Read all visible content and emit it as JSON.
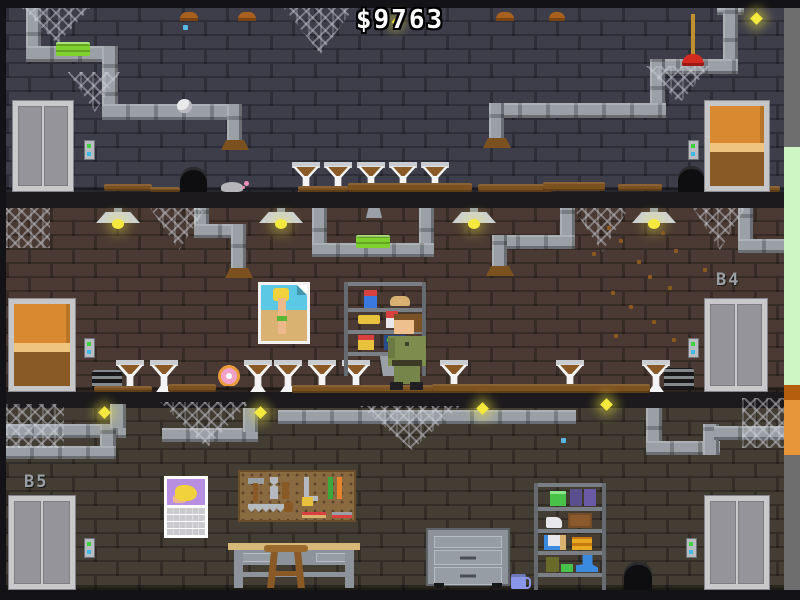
{
  "hud": {
    "money": "$9763"
  },
  "floor_labels": {
    "b4": "B4",
    "b5": "B5"
  },
  "palette": {
    "wall_top": "#3e3e4b",
    "wall_mid": "#4a3a33",
    "wall_bottom": "#433d33",
    "pipe": "#9aa0a5",
    "accent_green": "#7ed12e",
    "firefly": "#f5e93e",
    "door_wood": "#d98a30",
    "dirt": "#7c5120",
    "label_text": "#9aa0a5",
    "outside_green": "#cdf6c4",
    "outside_orange": "#e8963a"
  },
  "objects": {
    "floor_top": [
      "elevator",
      "pipes",
      "green-sponge",
      "cobwebs",
      "dirty-urinals",
      "mouse",
      "mouse-holes",
      "wooden-door",
      "plunger",
      "fireflies"
    ],
    "floor_b4": [
      "wooden-door",
      "hanging-lamps",
      "pipes",
      "green-sponge",
      "pinup-poster",
      "supply-shelf",
      "janitor",
      "dirty-urinals",
      "donut",
      "flies",
      "elevator"
    ],
    "floor_b5": [
      "elevator",
      "pipes",
      "fireflies",
      "cobwebs",
      "pinup-calendar",
      "pegboard-tools",
      "workbench",
      "stool",
      "rolling-cabinet",
      "mug",
      "storage-shelf",
      "mouse-hole",
      "elevator-right"
    ]
  },
  "sprites": [
    {
      "t": "pv",
      "x": 26,
      "y": 8,
      "w": 15,
      "h": 52,
      "n": "pipe-segment"
    },
    {
      "t": "ph",
      "x": 26,
      "y": 46,
      "w": 92,
      "h": 16,
      "n": "pipe-segment"
    },
    {
      "t": "pv",
      "x": 102,
      "y": 46,
      "w": 16,
      "h": 74,
      "n": "pipe-segment"
    },
    {
      "t": "ph",
      "x": 102,
      "y": 104,
      "w": 140,
      "h": 16,
      "n": "pipe-segment"
    },
    {
      "t": "pv",
      "x": 227,
      "y": 104,
      "w": 15,
      "h": 40,
      "n": "pipe-segment"
    },
    {
      "t": "rust",
      "x": 221,
      "y": 140,
      "w": 28,
      "h": 10,
      "n": "rust-stain"
    },
    {
      "t": "ph",
      "x": 717,
      "y": 8,
      "w": 27,
      "h": 7,
      "n": "pipe-flange"
    },
    {
      "t": "pv",
      "x": 723,
      "y": 8,
      "w": 15,
      "h": 58,
      "n": "pipe-segment"
    },
    {
      "t": "ph",
      "x": 652,
      "y": 59,
      "w": 86,
      "h": 15,
      "n": "pipe-segment"
    },
    {
      "t": "pv",
      "x": 650,
      "y": 59,
      "w": 15,
      "h": 55,
      "n": "pipe-segment"
    },
    {
      "t": "ph",
      "x": 494,
      "y": 103,
      "w": 172,
      "h": 15,
      "n": "pipe-segment"
    },
    {
      "t": "pv",
      "x": 489,
      "y": 103,
      "w": 15,
      "h": 39,
      "n": "pipe-segment"
    },
    {
      "t": "rust",
      "x": 483,
      "y": 138,
      "w": 28,
      "h": 10,
      "n": "rust-stain"
    },
    {
      "t": "sponge",
      "x": 56,
      "y": 42,
      "w": 34,
      "h": 14,
      "n": "green-sponge",
      "i": 1
    },
    {
      "t": "cap",
      "x": 180,
      "y": 12,
      "w": 18,
      "h": 9,
      "n": "ceiling-cap"
    },
    {
      "t": "cap",
      "x": 238,
      "y": 12,
      "w": 18,
      "h": 9,
      "n": "ceiling-cap"
    },
    {
      "t": "cap",
      "x": 496,
      "y": 12,
      "w": 18,
      "h": 9,
      "n": "ceiling-cap"
    },
    {
      "t": "cap",
      "x": 549,
      "y": 12,
      "w": 16,
      "h": 9,
      "n": "ceiling-cap"
    },
    {
      "t": "webt",
      "x": 22,
      "y": 8,
      "w": 68,
      "h": 36,
      "n": "cobweb",
      "i": 1
    },
    {
      "t": "webt",
      "x": 68,
      "y": 72,
      "w": 52,
      "h": 40,
      "n": "cobweb",
      "i": 1
    },
    {
      "t": "webt",
      "x": 284,
      "y": 8,
      "w": 70,
      "h": 46,
      "n": "cobweb",
      "i": 1
    },
    {
      "t": "webt",
      "x": 646,
      "y": 66,
      "w": 64,
      "h": 38,
      "n": "cobweb",
      "i": 1
    },
    {
      "t": "fly-y",
      "x": 752,
      "y": 14,
      "w": 9,
      "h": 9,
      "n": "firefly"
    },
    {
      "t": "fly-y",
      "x": 393,
      "y": 19,
      "w": 6,
      "h": 6,
      "n": "firefly"
    },
    {
      "t": "fly-b",
      "x": 183,
      "y": 25,
      "w": 5,
      "h": 5,
      "n": "blue-speck"
    },
    {
      "t": "paper",
      "x": 177,
      "y": 99,
      "w": 15,
      "h": 14,
      "n": "paper-ball",
      "i": 1
    },
    {
      "t": "plunger",
      "x": 682,
      "y": 14,
      "w": 22,
      "h": 52,
      "n": "plunger",
      "i": 1
    },
    {
      "t": "hole",
      "x": 180,
      "y": 167,
      "w": 27,
      "h": 25,
      "n": "mouse-hole"
    },
    {
      "t": "hole",
      "x": 678,
      "y": 166,
      "w": 27,
      "h": 26,
      "n": "mouse-hole"
    },
    {
      "t": "mouse",
      "x": 221,
      "y": 177,
      "w": 30,
      "h": 15,
      "n": "mouse",
      "i": 1
    },
    {
      "t": "callbtn",
      "x": 84,
      "y": 140,
      "n": "elevator-call-button",
      "i": 1
    },
    {
      "t": "callbtn",
      "x": 688,
      "y": 140,
      "n": "elevator-call-button",
      "i": 1
    },
    {
      "t": "funnel",
      "x": 292,
      "y": 162,
      "w": 28,
      "h": 30,
      "n": "dirty-urinal",
      "i": 1
    },
    {
      "t": "funnel",
      "x": 324,
      "y": 162,
      "w": 28,
      "h": 30,
      "n": "dirty-urinal",
      "i": 1
    },
    {
      "t": "funnel",
      "x": 357,
      "y": 162,
      "w": 28,
      "h": 30,
      "n": "dirty-urinal",
      "i": 1
    },
    {
      "t": "funnel",
      "x": 389,
      "y": 162,
      "w": 28,
      "h": 30,
      "n": "dirty-urinal",
      "i": 1
    },
    {
      "t": "funnel",
      "x": 421,
      "y": 162,
      "w": 28,
      "h": 30,
      "n": "dirty-urinal",
      "i": 1
    },
    {
      "t": "dirt",
      "x": 104,
      "y": 184,
      "w": 48,
      "h": 7,
      "n": "dirt-patch",
      "i": 1
    },
    {
      "t": "dirt",
      "x": 150,
      "y": 187,
      "w": 30,
      "h": 5,
      "n": "dirt-patch",
      "i": 1
    },
    {
      "t": "dirt",
      "x": 298,
      "y": 186,
      "w": 50,
      "h": 6,
      "n": "dirt-patch",
      "i": 1
    },
    {
      "t": "dirt",
      "x": 348,
      "y": 183,
      "w": 124,
      "h": 9,
      "n": "dirt-patch",
      "i": 1
    },
    {
      "t": "dirt",
      "x": 478,
      "y": 184,
      "w": 74,
      "h": 8,
      "n": "dirt-patch",
      "i": 1
    },
    {
      "t": "dirt",
      "x": 543,
      "y": 182,
      "w": 62,
      "h": 9,
      "n": "dirt-patch",
      "i": 1
    },
    {
      "t": "dirt",
      "x": 618,
      "y": 184,
      "w": 44,
      "h": 7,
      "n": "dirt-patch",
      "i": 1
    },
    {
      "t": "dirt",
      "x": 752,
      "y": 186,
      "w": 28,
      "h": 6,
      "n": "dirt-patch",
      "i": 1
    },
    {
      "t": "pv",
      "x": 194,
      "y": 208,
      "w": 15,
      "h": 30,
      "n": "pipe-segment"
    },
    {
      "t": "ph",
      "x": 194,
      "y": 224,
      "w": 52,
      "h": 14,
      "n": "pipe-segment"
    },
    {
      "t": "pv",
      "x": 231,
      "y": 224,
      "w": 15,
      "h": 48,
      "n": "pipe-segment"
    },
    {
      "t": "rust",
      "x": 225,
      "y": 268,
      "w": 28,
      "h": 10,
      "n": "rust-stain"
    },
    {
      "t": "pv",
      "x": 312,
      "y": 208,
      "w": 15,
      "h": 48,
      "n": "pipe-segment"
    },
    {
      "t": "pv",
      "x": 419,
      "y": 208,
      "w": 15,
      "h": 48,
      "n": "pipe-segment"
    },
    {
      "t": "ph",
      "x": 312,
      "y": 243,
      "w": 122,
      "h": 14,
      "n": "pipe-segment"
    },
    {
      "t": "sponge",
      "x": 356,
      "y": 235,
      "w": 34,
      "h": 13,
      "n": "green-sponge",
      "i": 1
    },
    {
      "t": "pv",
      "x": 560,
      "y": 208,
      "w": 15,
      "h": 30,
      "n": "pipe-segment"
    },
    {
      "t": "ph",
      "x": 492,
      "y": 235,
      "w": 83,
      "h": 14,
      "n": "pipe-segment"
    },
    {
      "t": "pv",
      "x": 492,
      "y": 235,
      "w": 15,
      "h": 34,
      "n": "pipe-segment"
    },
    {
      "t": "rust",
      "x": 486,
      "y": 266,
      "w": 28,
      "h": 10,
      "n": "rust-stain"
    },
    {
      "t": "pv",
      "x": 738,
      "y": 208,
      "w": 15,
      "h": 34,
      "n": "pipe-segment"
    },
    {
      "t": "ph",
      "x": 738,
      "y": 239,
      "w": 46,
      "h": 14,
      "n": "pipe-segment"
    },
    {
      "t": "graycap",
      "x": 366,
      "y": 208,
      "w": 16,
      "h": 10,
      "n": "ceiling-mount"
    },
    {
      "t": "lamp",
      "x": 96,
      "y": 208,
      "w": 44,
      "h": 22,
      "n": "hanging-lamp"
    },
    {
      "t": "lamp",
      "x": 259,
      "y": 208,
      "w": 44,
      "h": 22,
      "n": "hanging-lamp"
    },
    {
      "t": "lamp",
      "x": 452,
      "y": 208,
      "w": 44,
      "h": 22,
      "n": "hanging-lamp"
    },
    {
      "t": "lamp",
      "x": 632,
      "y": 208,
      "w": 44,
      "h": 22,
      "n": "hanging-lamp"
    },
    {
      "t": "web",
      "x": 6,
      "y": 208,
      "w": 44,
      "h": 40,
      "n": "cobweb",
      "i": 1
    },
    {
      "t": "webt",
      "x": 150,
      "y": 208,
      "w": 56,
      "h": 42,
      "n": "cobweb",
      "i": 1
    },
    {
      "t": "webt",
      "x": 573,
      "y": 208,
      "w": 56,
      "h": 44,
      "n": "cobweb",
      "i": 1
    },
    {
      "t": "webt",
      "x": 693,
      "y": 208,
      "w": 52,
      "h": 42,
      "n": "cobweb",
      "i": 1
    },
    {
      "t": "speck",
      "x": 607,
      "y": 226,
      "n": "fly"
    },
    {
      "t": "speck",
      "x": 619,
      "y": 239,
      "n": "fly"
    },
    {
      "t": "speck",
      "x": 661,
      "y": 231,
      "n": "fly"
    },
    {
      "t": "speck",
      "x": 674,
      "y": 249,
      "n": "fly"
    },
    {
      "t": "speck",
      "x": 637,
      "y": 260,
      "n": "fly"
    },
    {
      "t": "speck",
      "x": 648,
      "y": 275,
      "n": "fly"
    },
    {
      "t": "speck",
      "x": 611,
      "y": 291,
      "n": "fly"
    },
    {
      "t": "speck",
      "x": 668,
      "y": 286,
      "n": "fly"
    },
    {
      "t": "speck",
      "x": 703,
      "y": 268,
      "n": "fly"
    },
    {
      "t": "speck",
      "x": 629,
      "y": 305,
      "n": "fly"
    },
    {
      "t": "speck",
      "x": 652,
      "y": 320,
      "n": "fly"
    },
    {
      "t": "speck",
      "x": 614,
      "y": 334,
      "n": "fly"
    },
    {
      "t": "speck",
      "x": 672,
      "y": 338,
      "n": "fly"
    },
    {
      "t": "speck",
      "x": 592,
      "y": 252,
      "n": "fly"
    },
    {
      "t": "donut",
      "x": 216,
      "y": 364,
      "w": 26,
      "h": 22,
      "n": "donut",
      "i": 1
    },
    {
      "t": "funnel",
      "x": 116,
      "y": 360,
      "w": 28,
      "h": 32,
      "n": "dirty-urinal",
      "i": 1
    },
    {
      "t": "funnel",
      "x": 150,
      "y": 360,
      "w": 28,
      "h": 32,
      "n": "dirty-urinal",
      "i": 1
    },
    {
      "t": "funnel",
      "x": 244,
      "y": 360,
      "w": 28,
      "h": 32,
      "n": "dirty-urinal",
      "i": 1
    },
    {
      "t": "funnel",
      "x": 274,
      "y": 360,
      "w": 28,
      "h": 32,
      "n": "dirty-urinal",
      "i": 1
    },
    {
      "t": "funnel",
      "x": 308,
      "y": 360,
      "w": 28,
      "h": 32,
      "n": "dirty-urinal",
      "i": 1
    },
    {
      "t": "funnel",
      "x": 342,
      "y": 360,
      "w": 28,
      "h": 32,
      "n": "dirty-urinal",
      "i": 1
    },
    {
      "t": "funnel",
      "x": 440,
      "y": 360,
      "w": 28,
      "h": 32,
      "n": "dirty-urinal",
      "i": 1
    },
    {
      "t": "funnel",
      "x": 556,
      "y": 360,
      "w": 28,
      "h": 32,
      "n": "dirty-urinal",
      "i": 1
    },
    {
      "t": "funnel",
      "x": 642,
      "y": 360,
      "w": 28,
      "h": 32,
      "n": "dirty-urinal",
      "i": 1
    },
    {
      "t": "grate",
      "x": 92,
      "y": 370,
      "w": 30,
      "h": 20,
      "n": "floor-grate"
    },
    {
      "t": "grate",
      "x": 664,
      "y": 368,
      "w": 30,
      "h": 22,
      "n": "floor-grate"
    },
    {
      "t": "callbtn",
      "x": 84,
      "y": 338,
      "n": "elevator-call-button",
      "i": 1
    },
    {
      "t": "callbtn",
      "x": 688,
      "y": 338,
      "n": "elevator-call-button",
      "i": 1
    },
    {
      "t": "dirt",
      "x": 94,
      "y": 386,
      "w": 58,
      "h": 6,
      "n": "dirt-patch",
      "i": 1
    },
    {
      "t": "dirt",
      "x": 168,
      "y": 384,
      "w": 48,
      "h": 8,
      "n": "dirt-patch",
      "i": 1
    },
    {
      "t": "dirt",
      "x": 292,
      "y": 385,
      "w": 142,
      "h": 8,
      "n": "dirt-patch",
      "i": 1
    },
    {
      "t": "dirt",
      "x": 432,
      "y": 384,
      "w": 218,
      "h": 9,
      "n": "dirt-patch",
      "i": 1
    },
    {
      "t": "ph",
      "x": 6,
      "y": 424,
      "w": 120,
      "h": 14,
      "n": "pipe-segment"
    },
    {
      "t": "pv",
      "x": 100,
      "y": 424,
      "w": 16,
      "h": 34,
      "n": "pipe-segment"
    },
    {
      "t": "ph",
      "x": 6,
      "y": 446,
      "w": 110,
      "h": 13,
      "n": "pipe-segment"
    },
    {
      "t": "pv",
      "x": 110,
      "y": 404,
      "w": 16,
      "h": 24,
      "n": "pipe-segment"
    },
    {
      "t": "ph",
      "x": 162,
      "y": 428,
      "w": 96,
      "h": 14,
      "n": "pipe-segment"
    },
    {
      "t": "pv",
      "x": 243,
      "y": 408,
      "w": 15,
      "h": 24,
      "n": "pipe-segment"
    },
    {
      "t": "ph",
      "x": 278,
      "y": 410,
      "w": 298,
      "h": 14,
      "n": "pipe-segment"
    },
    {
      "t": "pv",
      "x": 646,
      "y": 408,
      "w": 16,
      "h": 46,
      "n": "pipe-segment"
    },
    {
      "t": "ph",
      "x": 646,
      "y": 441,
      "w": 74,
      "h": 14,
      "n": "pipe-segment"
    },
    {
      "t": "pv",
      "x": 703,
      "y": 424,
      "w": 16,
      "h": 31,
      "n": "pipe-segment"
    },
    {
      "t": "ph",
      "x": 714,
      "y": 426,
      "w": 70,
      "h": 14,
      "n": "pipe-segment"
    },
    {
      "t": "web",
      "x": 6,
      "y": 404,
      "w": 58,
      "h": 44,
      "n": "cobweb",
      "i": 1
    },
    {
      "t": "webt",
      "x": 160,
      "y": 402,
      "w": 90,
      "h": 46,
      "n": "cobweb",
      "i": 1
    },
    {
      "t": "webt",
      "x": 360,
      "y": 406,
      "w": 100,
      "h": 44,
      "n": "cobweb",
      "i": 1
    },
    {
      "t": "web",
      "x": 742,
      "y": 398,
      "w": 42,
      "h": 50,
      "n": "cobweb",
      "i": 1
    },
    {
      "t": "fly-y",
      "x": 100,
      "y": 408,
      "w": 9,
      "h": 9,
      "n": "firefly"
    },
    {
      "t": "fly-y",
      "x": 256,
      "y": 408,
      "w": 9,
      "h": 9,
      "n": "firefly"
    },
    {
      "t": "fly-y",
      "x": 478,
      "y": 404,
      "w": 9,
      "h": 9,
      "n": "firefly"
    },
    {
      "t": "fly-y",
      "x": 602,
      "y": 400,
      "w": 9,
      "h": 9,
      "n": "firefly"
    },
    {
      "t": "fly-b",
      "x": 561,
      "y": 438,
      "w": 5,
      "h": 5,
      "n": "blue-speck"
    },
    {
      "t": "hole",
      "x": 624,
      "y": 562,
      "w": 28,
      "h": 28,
      "n": "mouse-hole"
    },
    {
      "t": "callbtn",
      "x": 84,
      "y": 538,
      "n": "elevator-call-button",
      "i": 1
    },
    {
      "t": "callbtn",
      "x": 686,
      "y": 538,
      "n": "elevator-call-button",
      "i": 1
    }
  ]
}
